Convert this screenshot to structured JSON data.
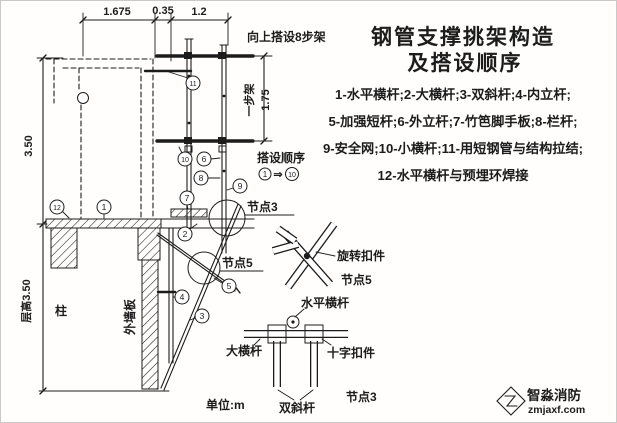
{
  "colors": {
    "title": "#7e332a",
    "ink": "#1c1c1c",
    "logo_icon": "#8a7263",
    "logo_name": "#55504a",
    "logo_site": "#8a6f5e"
  },
  "title": {
    "line1": "钢管支撑挑架构造",
    "line2": "及搭设顺序"
  },
  "legend": {
    "line1": "1-水平横杆;2-大横杆;3-双斜杆;4-内立杆;",
    "line2": "5-加强短杆;6-外立杆;7-竹笆脚手板;8-栏杆;",
    "line3": "9-安全网;10-小横杆;11-用短钢管与结构拉结;",
    "line4": "12-水平横杆与预埋环焊接"
  },
  "dimensions": {
    "top": [
      "1.675",
      "0.35",
      "1.2"
    ],
    "left_upper": "3.50",
    "left_lower": "层高3.50",
    "step_name": "一步架",
    "step_value": "1.75",
    "build_note": "向上搭设8步架",
    "unit_note": "单位:m"
  },
  "labels": {
    "column": "柱",
    "exterior_wall": "外墙板",
    "sequence_title": "搭设顺序",
    "sequence_arrow": "⇒",
    "node3": "节点3",
    "node5": "节点5",
    "rotating_coupler": "旋转扣件",
    "coupler_node": "节点5",
    "detail_horizontal_bar": "水平横杆",
    "detail_big_bar": "大横杆",
    "detail_cross_coupler": "十字扣件",
    "detail_double_diagonal": "双斜杆",
    "detail_node": "节点3"
  },
  "callouts": [
    "1",
    "2",
    "3",
    "4",
    "5",
    "6",
    "7",
    "8",
    "9",
    "10",
    "11",
    "12"
  ],
  "sequence": {
    "from": "1",
    "to": "10"
  },
  "logo": {
    "name": "智淼消防",
    "site": "zmjaxf.com"
  }
}
